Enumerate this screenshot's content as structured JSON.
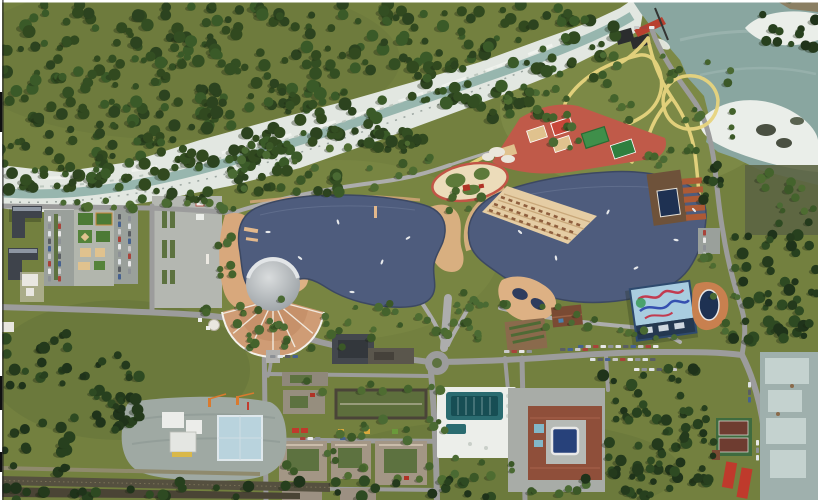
{
  "page": {
    "title": "Aerial 3D masterplan render — lakeside park and resort district"
  },
  "palette": {
    "grass": "#73803f",
    "grassl": "#7e8b48",
    "grassd": "#65733a",
    "rock": "#e2e7e1",
    "rockline": "#b9c4bb",
    "riverwater": "#8fb0a8",
    "reservoir": "#89a6a0",
    "resstreak": "#9fb8b2",
    "sand": "#eaeee9",
    "terrain": "#8b7f63",
    "rockdark": "#4a5042",
    "lake": "#4e5c7d",
    "lakedge": "#3c4862",
    "lakehl": "#6b7896",
    "road": "#9c9c9c",
    "roadl": "#adadad",
    "plaza": "#b4b7b1",
    "ypath": "#e7d47e",
    "tan": "#d8a87c",
    "tan2": "#ddb184",
    "beach": "#e5cda4",
    "beachline": "#c9a87a",
    "lounger": "#8f5f3e",
    "red": "#c05a49",
    "redeq": "#b03226",
    "court": "#4c7a35",
    "court2": "#3f8f4a",
    "courttan": "#e0c28e",
    "white": "#eceeea",
    "dome": "#b6babc",
    "domehl": "#d6d9da",
    "fan": "#cf9c75",
    "fan2": "#c08a62",
    "wall": "#3e434b",
    "wallhl": "#8d96a2",
    "beige": "#a39685",
    "beigeroof": "#cabcaa",
    "cyard": "#5d7240",
    "greenroof": "#5d6e3c",
    "garage": "#43474d",
    "pool": "#2a6b70",
    "pooldk": "#174e54",
    "hotelroof": "#8f4f3a",
    "hcourt": "#b6bab6",
    "cpool": "#27417a",
    "bluepool": "#82b7c8",
    "cabin": "#ad5a35",
    "deckb": "#6e523a",
    "deckpool": "#1e3152",
    "garden": "#8a6a4c",
    "house": "#7a4a33",
    "aquawall": "#2e4a6e",
    "aquaroof": "#a9cde0",
    "aquadark": "#243850",
    "muralred": "#c23b50",
    "muralblue": "#3550b0",
    "ovalpg": "#ecdcba",
    "ind": "#9fb0ad",
    "indpanel": "#c4d2cf",
    "cons": "#9fa9a3",
    "consblue": "#b9d3dd",
    "crane": "#d97a2e",
    "rail": "#55503f",
    "rail2": "#4a4435",
    "damred": "#b8402f",
    "damdark": "#2b2d2e",
    "shadow": "#1b2612"
  },
  "landmarks": {
    "river": "mountain river with white rocky banks",
    "reservoir": "teal reservoir with sandbars and dam",
    "left-lake": "west recreational lake with promenade",
    "right-lake": "east recreational lake with beach terraces",
    "amphitheater": "round domed amphitheater with fan seating",
    "sports-zone": "red rubber sports courts cluster",
    "aqua-park": "aqua park with painted slide roof and oval pool",
    "hotel-complex": "courtyard hotel with inner pool",
    "pool-complex": "open-air 50 m swimming pool",
    "construction-site": "construction site with cranes",
    "industrial-yard": "concrete panel yard",
    "railway": "railway line"
  },
  "trees": {
    "seed": 20240718,
    "palettes": {
      "f": [
        "#2c431f",
        "#334e22",
        "#3a5a28",
        "#31491f"
      ],
      "p": [
        "#44632c",
        "#4e6c31",
        "#3b5827",
        "#4a6a33"
      ],
      "d": [
        "#1f331a",
        "#27401e",
        "#2e4a22",
        "#243a1c"
      ]
    },
    "radius": {
      "f": [
        3,
        6.5
      ],
      "p": [
        2.5,
        5
      ],
      "d": [
        3,
        6
      ]
    },
    "regions": [
      [
        0,
        4,
        600,
        26,
        70,
        "f"
      ],
      [
        0,
        30,
        545,
        34,
        85,
        "f"
      ],
      [
        0,
        64,
        470,
        36,
        85,
        "f"
      ],
      [
        0,
        100,
        390,
        36,
        75,
        "f"
      ],
      [
        0,
        136,
        300,
        30,
        55,
        "f"
      ],
      [
        0,
        166,
        165,
        24,
        32,
        "f"
      ],
      [
        170,
        150,
        120,
        22,
        20,
        "f"
      ],
      [
        300,
        118,
        120,
        24,
        18,
        "f"
      ],
      [
        420,
        86,
        110,
        22,
        16,
        "f"
      ],
      [
        520,
        56,
        90,
        22,
        12,
        "f"
      ],
      [
        558,
        18,
        62,
        30,
        10,
        "f"
      ],
      [
        238,
        168,
        120,
        26,
        16,
        "f"
      ],
      [
        358,
        132,
        92,
        22,
        12,
        "f"
      ],
      [
        468,
        100,
        72,
        20,
        9,
        "f"
      ],
      [
        138,
        190,
        84,
        12,
        8,
        "f"
      ],
      [
        228,
        142,
        210,
        50,
        24,
        "p"
      ],
      [
        445,
        182,
        38,
        40,
        6,
        "p"
      ],
      [
        545,
        55,
        150,
        95,
        26,
        "p"
      ],
      [
        688,
        62,
        46,
        75,
        9,
        "p"
      ],
      [
        200,
        298,
        140,
        58,
        20,
        "p"
      ],
      [
        355,
        300,
        130,
        42,
        16,
        "p"
      ],
      [
        455,
        302,
        55,
        26,
        7,
        "p"
      ],
      [
        540,
        300,
        55,
        35,
        7,
        "p"
      ],
      [
        218,
        208,
        16,
        92,
        9,
        "p"
      ],
      [
        150,
        192,
        72,
        14,
        8,
        "p"
      ],
      [
        44,
        200,
        92,
        10,
        8,
        "p"
      ],
      [
        415,
        292,
        80,
        52,
        8,
        "p"
      ],
      [
        340,
        418,
        100,
        20,
        8,
        "p"
      ],
      [
        285,
        440,
        145,
        45,
        12,
        "p"
      ],
      [
        300,
        380,
        120,
        12,
        6,
        "p"
      ],
      [
        430,
        378,
        20,
        110,
        6,
        "p"
      ],
      [
        448,
        455,
        65,
        35,
        8,
        "p"
      ],
      [
        530,
        484,
        70,
        14,
        6,
        "p"
      ],
      [
        620,
        330,
        60,
        18,
        6,
        "p"
      ],
      [
        700,
        250,
        40,
        90,
        10,
        "p"
      ],
      [
        758,
        170,
        60,
        55,
        12,
        "p"
      ],
      [
        640,
        150,
        60,
        20,
        8,
        "p"
      ],
      [
        505,
        92,
        60,
        18,
        6,
        "p"
      ],
      [
        240,
        318,
        110,
        30,
        10,
        "p"
      ],
      [
        733,
        222,
        85,
        125,
        48,
        "d"
      ],
      [
        603,
        365,
        112,
        132,
        70,
        "d"
      ],
      [
        760,
        0,
        58,
        50,
        12,
        "d"
      ],
      [
        140,
        478,
        460,
        20,
        26,
        "d"
      ],
      [
        0,
        488,
        140,
        12,
        8,
        "d"
      ],
      [
        60,
        348,
        80,
        80,
        26,
        "d"
      ],
      [
        0,
        330,
        70,
        60,
        16,
        "d"
      ],
      [
        0,
        420,
        70,
        75,
        18,
        "d"
      ],
      [
        100,
        390,
        45,
        45,
        10,
        "d"
      ],
      [
        625,
        470,
        90,
        28,
        10,
        "d"
      ],
      [
        700,
        165,
        26,
        55,
        8,
        "d"
      ]
    ]
  },
  "cars": {
    "colors": [
      "#e8e8e8",
      "#c9c9c9",
      "#5a5e63",
      "#8d9196",
      "#a8433a",
      "#46618f",
      "#dfe3e6"
    ],
    "rows": [
      [
        48,
        216,
        "v",
        9
      ],
      [
        58,
        216,
        "v",
        9
      ],
      [
        118,
        214,
        "v",
        9
      ],
      [
        128,
        216,
        "v",
        8
      ],
      [
        703,
        230,
        "v",
        4
      ],
      [
        578,
        345,
        "h",
        11
      ],
      [
        590,
        358,
        "h",
        9
      ],
      [
        634,
        368,
        "h",
        6
      ],
      [
        504,
        350,
        "h",
        4
      ],
      [
        560,
        348,
        "h",
        4
      ],
      [
        270,
        355,
        "h",
        4
      ],
      [
        300,
        437,
        "h",
        3
      ],
      [
        340,
        437,
        "h",
        2
      ],
      [
        748,
        382,
        "v",
        3
      ],
      [
        756,
        440,
        "v",
        3
      ],
      [
        634,
        26,
        "h",
        3
      ]
    ]
  },
  "boats": [
    [
      268,
      232
    ],
    [
      300,
      258
    ],
    [
      338,
      222
    ],
    [
      382,
      262
    ],
    [
      408,
      238
    ],
    [
      352,
      292
    ],
    [
      520,
      232
    ],
    [
      556,
      258
    ],
    [
      608,
      212
    ],
    [
      636,
      268
    ],
    [
      676,
      240
    ],
    [
      694,
      210
    ]
  ]
}
